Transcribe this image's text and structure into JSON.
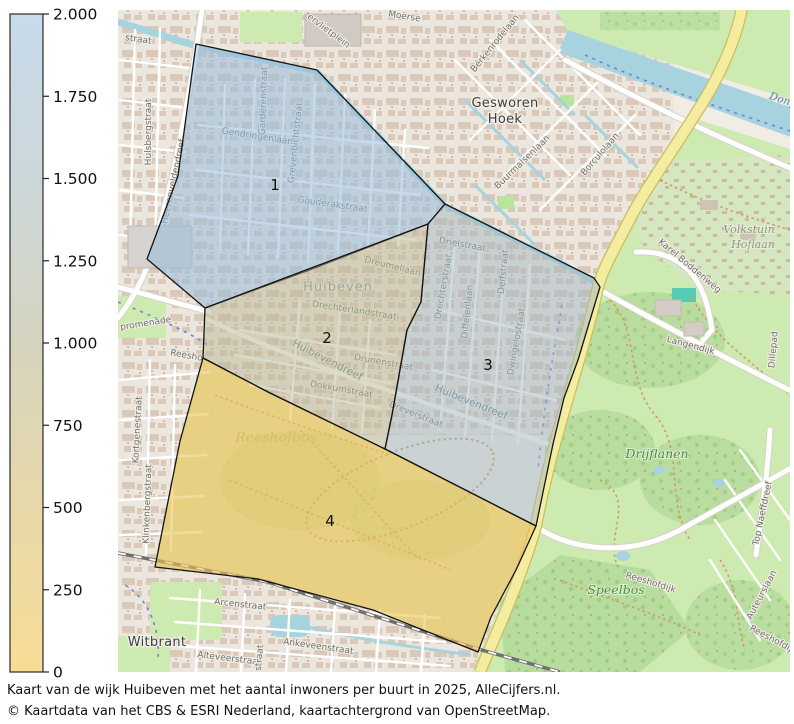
{
  "legend": {
    "ticks": [
      "2.000",
      "1.750",
      "1.500",
      "1.250",
      "1.000",
      "750",
      "500",
      "250",
      "0"
    ],
    "gradient": [
      "#c7dbeb",
      "#ccd7da",
      "#d5d4bf",
      "#e8d8a9",
      "#f7dd95"
    ]
  },
  "map": {
    "regions": [
      {
        "number": "1",
        "fill": "#97bbdc",
        "opacity": 0.55,
        "points": "196,44 317,70 445,204 428,224 307,271 205,308 147,259 178,176",
        "label_x": 275,
        "label_y": 190
      },
      {
        "number": "2",
        "fill": "#b9b795",
        "opacity": 0.5,
        "points": "205,308 428,224 421,302 407,330 392,415 385,449 268,392 203,358",
        "label_x": 327,
        "label_y": 343
      },
      {
        "number": "3",
        "fill": "#a3b7c2",
        "opacity": 0.5,
        "points": "445,204 594,278 600,287 578,360 564,398 553,444 536,526 385,449 392,415 407,330 421,302 428,224",
        "label_x": 488,
        "label_y": 370
      },
      {
        "number": "4",
        "fill": "#eec25d",
        "opacity": 0.6,
        "points": "203,358 268,392 385,449 536,526 516,570 491,617 478,652 373,610 258,579 155,567 180,441",
        "label_x": 330,
        "label_y": 526
      }
    ],
    "labels": [
      {
        "text": "ervlietplein",
        "x": 327,
        "y": 33,
        "rot": 37,
        "kind": "street"
      },
      {
        "text": "Moerse",
        "x": 404,
        "y": 19,
        "rot": 9,
        "kind": "street"
      },
      {
        "text": "Berkenrodelaan",
        "x": 497,
        "y": 45,
        "rot": -51,
        "kind": "street"
      },
      {
        "text": "Buurmalsenlaan",
        "x": 524,
        "y": 164,
        "rot": -44,
        "kind": "street"
      },
      {
        "text": "Borculolaan",
        "x": 602,
        "y": 156,
        "rot": -49,
        "kind": "street"
      },
      {
        "text": "Karel Boddenweg",
        "x": 688,
        "y": 268,
        "rot": 40,
        "kind": "street"
      },
      {
        "text": "Langendijk",
        "x": 690,
        "y": 348,
        "rot": 15,
        "kind": "street"
      },
      {
        "text": "Dillepad",
        "x": 776,
        "y": 350,
        "rot": -85,
        "kind": "street"
      },
      {
        "text": "Top Naeffdreef",
        "x": 765,
        "y": 514,
        "rot": -78,
        "kind": "street"
      },
      {
        "text": "Auteurslaan",
        "x": 764,
        "y": 596,
        "rot": -62,
        "kind": "street"
      },
      {
        "text": "Reeshofdijk",
        "x": 650,
        "y": 585,
        "rot": 17,
        "kind": "street"
      },
      {
        "text": "Reeshofdijk",
        "x": 772,
        "y": 642,
        "rot": 28,
        "kind": "street"
      },
      {
        "text": "Arcenstraat",
        "x": 240,
        "y": 607,
        "rot": 6,
        "kind": "street"
      },
      {
        "text": "Ankeveenstraat",
        "x": 318,
        "y": 649,
        "rot": 8,
        "kind": "street"
      },
      {
        "text": "Alteveerstraat",
        "x": 229,
        "y": 661,
        "rot": 7,
        "kind": "street"
      },
      {
        "text": "straat",
        "x": 262,
        "y": 658,
        "rot": -85,
        "kind": "street"
      },
      {
        "text": "straat",
        "x": 138,
        "y": 42,
        "rot": 8,
        "kind": "street"
      },
      {
        "text": "Hulsbergstraat",
        "x": 151,
        "y": 132,
        "rot": -90,
        "kind": "street"
      },
      {
        "text": "Heerenveldendreef",
        "x": 176,
        "y": 182,
        "rot": -78,
        "kind": "street"
      },
      {
        "text": "Kortgenestraat",
        "x": 140,
        "y": 430,
        "rot": -87,
        "kind": "street"
      },
      {
        "text": "Klinkenbergstraat",
        "x": 150,
        "y": 504,
        "rot": -88,
        "kind": "street"
      },
      {
        "text": "promenade",
        "x": 146,
        "y": 326,
        "rot": -9,
        "kind": "street"
      },
      {
        "text": "Reesho",
        "x": 186,
        "y": 358,
        "rot": 10,
        "kind": "street"
      },
      {
        "text": "Gendringenlaan",
        "x": 257,
        "y": 139,
        "rot": 9,
        "kind": "street"
      },
      {
        "text": "Garderenstraat",
        "x": 266,
        "y": 101,
        "rot": -88,
        "kind": "street"
      },
      {
        "text": "Grevenbichtstraat",
        "x": 298,
        "y": 143,
        "rot": -84,
        "kind": "street"
      },
      {
        "text": "Gouderakstraat",
        "x": 332,
        "y": 207,
        "rot": 8,
        "kind": "street"
      },
      {
        "text": "Dreumellaan",
        "x": 392,
        "y": 269,
        "rot": 14,
        "kind": "street"
      },
      {
        "text": "Drechterlandstraat",
        "x": 354,
        "y": 313,
        "rot": 9,
        "kind": "street"
      },
      {
        "text": "Huibevendreef",
        "x": 326,
        "y": 363,
        "rot": 27,
        "kind": "street-lg"
      },
      {
        "text": "Drunenstraat",
        "x": 383,
        "y": 365,
        "rot": 10,
        "kind": "street"
      },
      {
        "text": "Dokkumstraat",
        "x": 341,
        "y": 392,
        "rot": 10,
        "kind": "street"
      },
      {
        "text": "Dreverstraat",
        "x": 415,
        "y": 417,
        "rot": 22,
        "kind": "street"
      },
      {
        "text": "Drielstraat",
        "x": 462,
        "y": 247,
        "rot": 10,
        "kind": "street"
      },
      {
        "text": "Drechterstraat",
        "x": 446,
        "y": 287,
        "rot": -80,
        "kind": "street"
      },
      {
        "text": "Diffelenlaan",
        "x": 470,
        "y": 312,
        "rot": -84,
        "kind": "street"
      },
      {
        "text": "Delfstraat",
        "x": 506,
        "y": 272,
        "rot": -84,
        "kind": "street"
      },
      {
        "text": "Dwingelostraat",
        "x": 519,
        "y": 342,
        "rot": -80,
        "kind": "street"
      },
      {
        "text": "Huibevendreef",
        "x": 470,
        "y": 405,
        "rot": 22,
        "kind": "street-lg"
      },
      {
        "text": "Gesworen",
        "x": 505,
        "y": 107,
        "rot": 0,
        "kind": "place"
      },
      {
        "text": "Hoek",
        "x": 505,
        "y": 123,
        "rot": 0,
        "kind": "place"
      },
      {
        "text": "Witbrant",
        "x": 157,
        "y": 646,
        "rot": 0,
        "kind": "place"
      },
      {
        "text": "Huibeven",
        "x": 338,
        "y": 291,
        "rot": 0,
        "kind": "place-faded"
      },
      {
        "text": "Drijflanen",
        "x": 657,
        "y": 458,
        "rot": 0,
        "kind": "park"
      },
      {
        "text": "Speelbos",
        "x": 616,
        "y": 594,
        "rot": 0,
        "kind": "park"
      },
      {
        "text": "Volkstuin",
        "x": 749,
        "y": 233,
        "rot": 0,
        "kind": "park2"
      },
      {
        "text": "Hoflaan",
        "x": 753,
        "y": 248,
        "rot": 0,
        "kind": "park2"
      },
      {
        "text": "Reeshofbos",
        "x": 276,
        "y": 442,
        "rot": 0,
        "kind": "forest-faded"
      },
      {
        "text": "Donge",
        "x": 785,
        "y": 104,
        "rot": 18,
        "kind": "water"
      }
    ]
  },
  "caption": {
    "line1": "Kaart van de wijk Huibeven met het aantal inwoners per buurt in 2025, AlleCijfers.nl.",
    "line2": "© Kaartdata van het CBS & ESRI Nederland, kaartachtergrond van OpenStreetMap."
  }
}
